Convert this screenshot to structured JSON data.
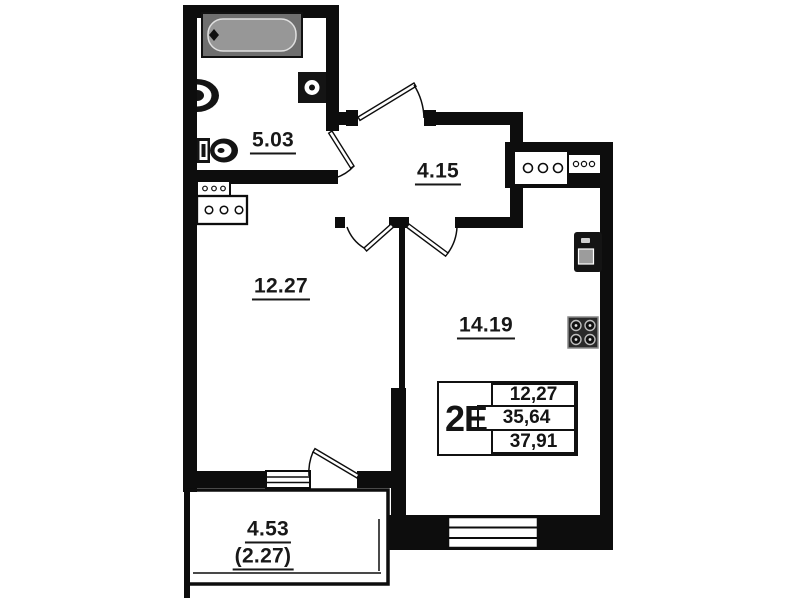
{
  "floor_plan": {
    "unit_type": "2E",
    "areas": {
      "bathroom": "5.03",
      "hallway": "4.15",
      "room": "12.27",
      "kitchen_living": "14.19",
      "balcony": "4.53",
      "balcony_reduced": "(2.27)"
    },
    "stamp": {
      "unit_type": "2E",
      "living_area": "12,27",
      "apartment_area": "35,64",
      "total_area": "37,91"
    },
    "colors": {
      "wall": "#0d0d0d",
      "background": "#ffffff",
      "bathtub": "#979797"
    }
  }
}
